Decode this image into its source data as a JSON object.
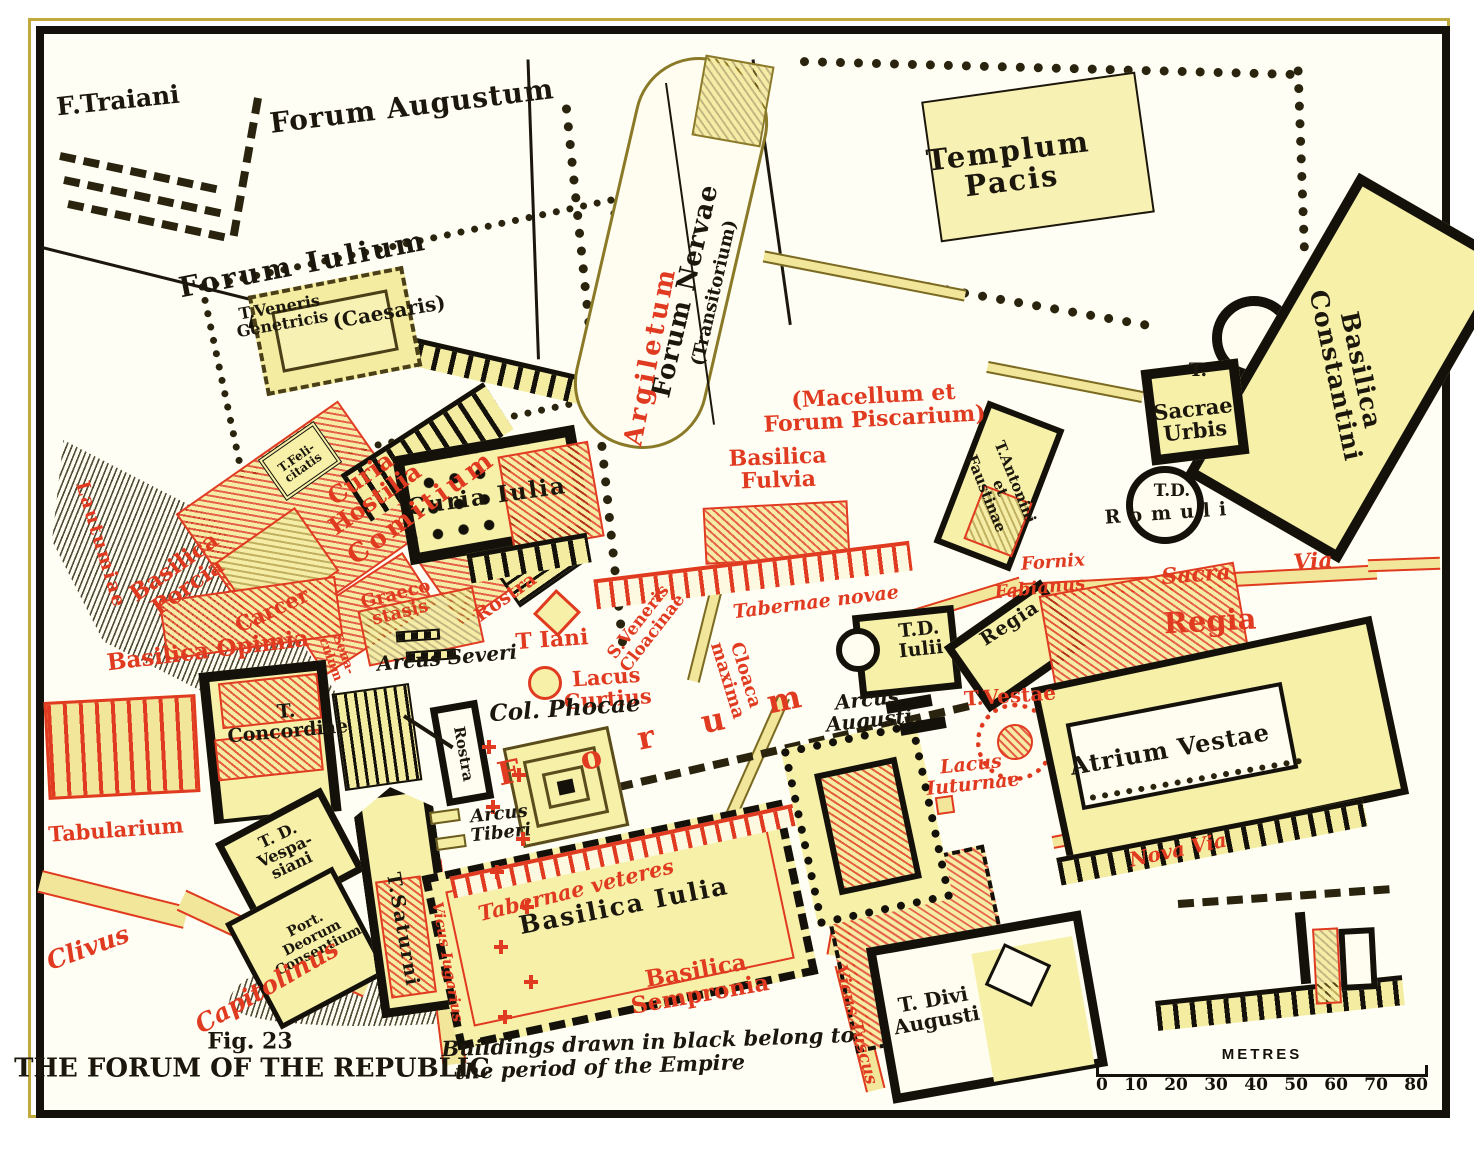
{
  "figure": {
    "number": "Fig. 23",
    "title": "THE FORUM OF THE REPUBLIC"
  },
  "scale": {
    "unit": "METRES",
    "ticks": [
      "0",
      "10",
      "20",
      "30",
      "40",
      "50",
      "60",
      "70",
      "80"
    ]
  },
  "colors": {
    "republic_red": "#e03a20",
    "empire_black": "#14110a",
    "building_fill": "#f4eda1",
    "paper": "#fffef4"
  },
  "map": {
    "labels": [
      {
        "id": "f-traiani",
        "text": "F.Traiani",
        "x": 118,
        "y": 101,
        "r": -6,
        "s": 25
      },
      {
        "id": "forum-augustum",
        "text": "Forum Augustum",
        "x": 412,
        "y": 106,
        "r": -7,
        "s": 28,
        "ls": 1
      },
      {
        "id": "forum-iulium",
        "text": "Forum Iulium",
        "x": 303,
        "y": 264,
        "r": -11,
        "s": 28,
        "ls": 3
      },
      {
        "id": "caesaris",
        "text": "(Caesaris)",
        "x": 389,
        "y": 312,
        "r": -10,
        "s": 20
      },
      {
        "id": "t-veneris-genetricis",
        "text": "T.Veneris\nGenetricis",
        "x": 281,
        "y": 316,
        "r": -10,
        "s": 16
      },
      {
        "id": "templum-pacis",
        "text": "Templum\nPacis",
        "x": 1010,
        "y": 166,
        "r": -7,
        "s": 29,
        "ls": 2
      },
      {
        "id": "forum-nervae",
        "text": "Forum Nervae",
        "x": 686,
        "y": 291,
        "r": -77,
        "s": 26,
        "ls": 1
      },
      {
        "id": "transitorium",
        "text": "(Transitorium)",
        "x": 715,
        "y": 293,
        "r": -77,
        "s": 18
      },
      {
        "id": "argiletum",
        "text": "Argiletum",
        "x": 651,
        "y": 356,
        "r": -79,
        "s": 26,
        "c": "red",
        "ls": 4
      },
      {
        "id": "macellum-forum-piscarium",
        "text": "(Macellum et\nForum Piscarium)",
        "x": 874,
        "y": 408,
        "r": -3,
        "s": 22,
        "c": "red"
      },
      {
        "id": "basilica-fulvia",
        "text": "Basilica\nFulvia",
        "x": 778,
        "y": 469,
        "r": -2,
        "s": 22,
        "c": "red"
      },
      {
        "id": "tabernae-novae",
        "text": "Tabernae novae",
        "x": 816,
        "y": 603,
        "r": -7,
        "s": 19,
        "c": "red",
        "it": 1
      },
      {
        "id": "sacra",
        "text": "Sacra",
        "x": 1196,
        "y": 575,
        "r": -4,
        "s": 22,
        "c": "red",
        "it": 1
      },
      {
        "id": "via",
        "text": "Via",
        "x": 1313,
        "y": 562,
        "r": -4,
        "s": 22,
        "c": "red",
        "it": 1
      },
      {
        "id": "fornix",
        "text": "Fornix",
        "x": 1053,
        "y": 563,
        "r": -4,
        "s": 18,
        "c": "red",
        "it": 1
      },
      {
        "id": "fabianus",
        "text": "Fabianus",
        "x": 1040,
        "y": 589,
        "r": -6,
        "s": 18,
        "c": "red",
        "it": 1
      },
      {
        "id": "t-sacrae-urbis-t",
        "text": "T.",
        "x": 1198,
        "y": 371,
        "r": 0,
        "s": 19
      },
      {
        "id": "sacrae-urbis",
        "text": "Sacrae\nUrbis",
        "x": 1194,
        "y": 420,
        "r": -6,
        "s": 21
      },
      {
        "id": "t-d-abbrev",
        "text": "T.D.",
        "x": 1172,
        "y": 492,
        "r": 0,
        "s": 17
      },
      {
        "id": "romuli",
        "text": "Romuli",
        "x": 1170,
        "y": 514,
        "r": -4,
        "s": 19,
        "ls": 9
      },
      {
        "id": "basilica-constantini",
        "text": "Basilica\nConstantini",
        "x": 1348,
        "y": 373,
        "r": 78,
        "s": 25,
        "ls": 1
      },
      {
        "id": "t-antonini-faustinae",
        "text": "T.Antonini\net\nFaustinae",
        "x": 1000,
        "y": 488,
        "r": 68,
        "s": 15
      },
      {
        "id": "curia-iulia",
        "text": "Curia Iulia",
        "x": 487,
        "y": 497,
        "r": -8,
        "s": 23,
        "ls": 2
      },
      {
        "id": "curia-hostilia",
        "text": "Curia\nHostilia",
        "x": 368,
        "y": 489,
        "r": -35,
        "s": 24,
        "c": "red"
      },
      {
        "id": "comitium",
        "text": "Comitium",
        "x": 422,
        "y": 508,
        "r": -36,
        "s": 26,
        "c": "red",
        "ls": 4
      },
      {
        "id": "graecostasis",
        "text": "Graeco\nstasis",
        "x": 398,
        "y": 604,
        "r": -14,
        "s": 18,
        "c": "red"
      },
      {
        "id": "rostra-red",
        "text": "Rostra",
        "x": 506,
        "y": 598,
        "r": -35,
        "s": 19,
        "c": "red"
      },
      {
        "id": "t-felicitatis",
        "text": "T.Feli-\ncitatis",
        "x": 300,
        "y": 463,
        "r": -35,
        "s": 12
      },
      {
        "id": "carcer",
        "text": "Carcer",
        "x": 272,
        "y": 610,
        "r": -25,
        "s": 21,
        "c": "red"
      },
      {
        "id": "basilica-porcia",
        "text": "Basilica\nPorcia",
        "x": 181,
        "y": 577,
        "r": -35,
        "s": 23,
        "c": "red"
      },
      {
        "id": "lautumiae",
        "text": "Lautumiae",
        "x": 100,
        "y": 545,
        "r": 73,
        "s": 19,
        "c": "red",
        "ls": 2
      },
      {
        "id": "basilica-opimia",
        "text": "Basilica Opimia",
        "x": 208,
        "y": 651,
        "r": -7,
        "s": 23,
        "c": "red"
      },
      {
        "id": "senaculum",
        "text": "Sena-\nculum",
        "x": 337,
        "y": 657,
        "r": 70,
        "s": 13,
        "c": "red"
      },
      {
        "id": "arcus-severi",
        "text": "Arcus Severi",
        "x": 447,
        "y": 658,
        "r": -5,
        "s": 20,
        "it": 1
      },
      {
        "id": "t-iani",
        "text": "T Iani",
        "x": 552,
        "y": 640,
        "r": -4,
        "s": 22,
        "c": "red"
      },
      {
        "id": "lacus-curtius",
        "text": "Lacus\nCurtius",
        "x": 607,
        "y": 688,
        "r": -4,
        "s": 21,
        "c": "red"
      },
      {
        "id": "col-phocae",
        "text": "Col. Phocae",
        "x": 565,
        "y": 709,
        "r": -4,
        "s": 23,
        "it": 1
      },
      {
        "id": "forum-letter-f",
        "text": "F",
        "x": 509,
        "y": 773,
        "r": -12,
        "s": 32,
        "c": "red"
      },
      {
        "id": "forum-letter-o",
        "text": "o",
        "x": 591,
        "y": 758,
        "r": -12,
        "s": 32,
        "c": "red"
      },
      {
        "id": "forum-letter-r",
        "text": "r",
        "x": 646,
        "y": 738,
        "r": -12,
        "s": 32,
        "c": "red"
      },
      {
        "id": "forum-letter-u",
        "text": "u",
        "x": 713,
        "y": 721,
        "r": -12,
        "s": 32,
        "c": "red"
      },
      {
        "id": "forum-letter-m",
        "text": "m",
        "x": 784,
        "y": 700,
        "r": -12,
        "s": 32,
        "c": "red"
      },
      {
        "id": "s-veneris-cloacinae",
        "text": "S.Veneris\nCloacinae",
        "x": 646,
        "y": 628,
        "r": -52,
        "s": 17,
        "c": "red"
      },
      {
        "id": "cloaca-maxima",
        "text": "Cloaca\nmaxima",
        "x": 736,
        "y": 678,
        "r": 73,
        "s": 18,
        "c": "red"
      },
      {
        "id": "tabernae-veteres",
        "text": "Tabernae veteres",
        "x": 576,
        "y": 890,
        "r": -14,
        "s": 21,
        "c": "red",
        "it": 1
      },
      {
        "id": "basilica-iulia",
        "text": "Basilica Iulia",
        "x": 624,
        "y": 906,
        "r": -11,
        "s": 25,
        "ls": 2
      },
      {
        "id": "basilica-sempronia",
        "text": "Basilica\nSempronia",
        "x": 698,
        "y": 983,
        "r": -10,
        "s": 23,
        "c": "red"
      },
      {
        "id": "vicus-iugarius",
        "text": "Vicus Iugarius",
        "x": 447,
        "y": 962,
        "r": 80,
        "s": 15,
        "c": "red",
        "it": 1
      },
      {
        "id": "arcus-tiberi",
        "text": "Arcus\nTiberi",
        "x": 500,
        "y": 824,
        "r": -6,
        "s": 18,
        "it": 1
      },
      {
        "id": "rostra-box",
        "text": "Rostra",
        "x": 463,
        "y": 754,
        "r": 80,
        "s": 15
      },
      {
        "id": "t-d-iulii",
        "text": "T.D.\nIulii",
        "x": 920,
        "y": 640,
        "r": -6,
        "s": 19
      },
      {
        "id": "arcus-augusti",
        "text": "Arcus\nAugusti",
        "x": 868,
        "y": 710,
        "r": -6,
        "s": 20,
        "it": 1
      },
      {
        "id": "t-vestae",
        "text": "T.Vestae",
        "x": 1010,
        "y": 696,
        "r": -4,
        "s": 20,
        "c": "red"
      },
      {
        "id": "lacus-iuturnae",
        "text": "Lacus\nIuturnae",
        "x": 972,
        "y": 775,
        "r": -6,
        "s": 19,
        "c": "red",
        "it": 1
      },
      {
        "id": "regia-small",
        "text": "Regia",
        "x": 1010,
        "y": 624,
        "r": -33,
        "s": 19,
        "ls": 1
      },
      {
        "id": "regia",
        "text": "Regia",
        "x": 1210,
        "y": 621,
        "r": -3,
        "s": 29,
        "c": "red"
      },
      {
        "id": "atrium-vestae",
        "text": "Atrium Vestae",
        "x": 1170,
        "y": 750,
        "r": -10,
        "s": 24,
        "ls": 1
      },
      {
        "id": "nova-via",
        "text": "Nova Via",
        "x": 1178,
        "y": 850,
        "r": -12,
        "s": 20,
        "c": "red",
        "it": 1
      },
      {
        "id": "vicus-tuscus",
        "text": "Vicus Tuscus",
        "x": 855,
        "y": 1025,
        "r": 75,
        "s": 17,
        "c": "red",
        "it": 1
      },
      {
        "id": "t-divi-augusti",
        "text": "T. Divi\nAugusti",
        "x": 935,
        "y": 1010,
        "r": -10,
        "s": 20
      },
      {
        "id": "tabularium",
        "text": "Tabularium",
        "x": 116,
        "y": 830,
        "r": -4,
        "s": 21,
        "c": "red"
      },
      {
        "id": "t-d-vespasiani",
        "text": "T. D.\nVespa-\nsiani",
        "x": 285,
        "y": 851,
        "r": -25,
        "s": 16
      },
      {
        "id": "port-deorum-consentium",
        "text": "Port.\nDeorum\nConsentium",
        "x": 312,
        "y": 938,
        "r": -27,
        "s": 14
      },
      {
        "id": "t-saturni",
        "text": "T.Saturni",
        "x": 402,
        "y": 930,
        "r": 80,
        "s": 19,
        "ls": 2
      },
      {
        "id": "t-concordiae",
        "text": "T.\nConcordiae",
        "x": 287,
        "y": 722,
        "r": -5,
        "s": 19
      },
      {
        "id": "clivus",
        "text": "Clivus",
        "x": 88,
        "y": 948,
        "r": -20,
        "s": 25,
        "c": "red",
        "it": 1
      },
      {
        "id": "capitolinus",
        "text": "Capitolinus",
        "x": 267,
        "y": 987,
        "r": -30,
        "s": 25,
        "c": "red",
        "it": 1
      },
      {
        "id": "fig-number",
        "text": "Fig. 23",
        "x": 250,
        "y": 1042,
        "r": 0,
        "s": 22
      },
      {
        "id": "map-title",
        "text": "THE FORUM OF THE REPUBLIC",
        "x": 252,
        "y": 1069,
        "r": 0,
        "s": 26
      },
      {
        "id": "legend-line1",
        "text": "Buildings drawn in black belong to",
        "x": 648,
        "y": 1042,
        "r": -2,
        "s": 21,
        "it": 1
      },
      {
        "id": "legend-line2",
        "text": "the period of the Empire",
        "x": 600,
        "y": 1067,
        "r": -2,
        "s": 21,
        "it": 1
      }
    ]
  }
}
